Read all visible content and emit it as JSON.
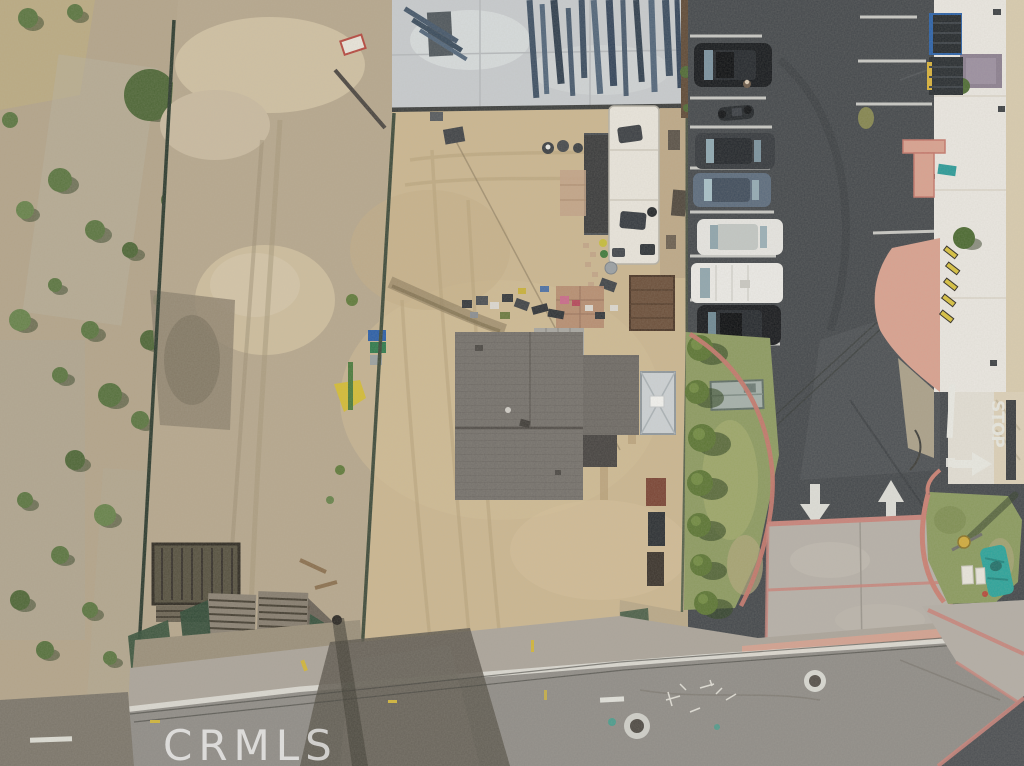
{
  "watermark": {
    "text": "CRMLS"
  },
  "road_markings": {
    "stop_text": "STOP"
  },
  "palette": {
    "watermark_color": "#ffffff",
    "road_paint": "#e9e9e3",
    "dirt_lot": "#cbb690",
    "asphalt_parking": "#43474b",
    "asphalt_street": "#8f8c87",
    "roof_gray": "#74706b",
    "curb_pink": "#c4776b",
    "sidewalk_salmon": "#d9a18f",
    "grass_green": "#8c9a60",
    "fence_green": "#35503a",
    "rv_white": "#e9e5dc",
    "tarp_teal": "#2ba39a"
  },
  "scene": {
    "setting": "Aerial drone view of a graded dirt lot with a gray-roofed house, RV trailer and construction slab with steel framing; scrub land on the left, commercial parking lot with white-roofed building on the right, street along the bottom",
    "vehicles": [
      {
        "type": "suv",
        "color": "black"
      },
      {
        "type": "motorcycle",
        "color": "black"
      },
      {
        "type": "sedan",
        "color": "dark gray"
      },
      {
        "type": "sedan",
        "color": "blue gray"
      },
      {
        "type": "sedan",
        "color": "white"
      },
      {
        "type": "van",
        "color": "white"
      },
      {
        "type": "suv",
        "color": "black"
      }
    ]
  }
}
